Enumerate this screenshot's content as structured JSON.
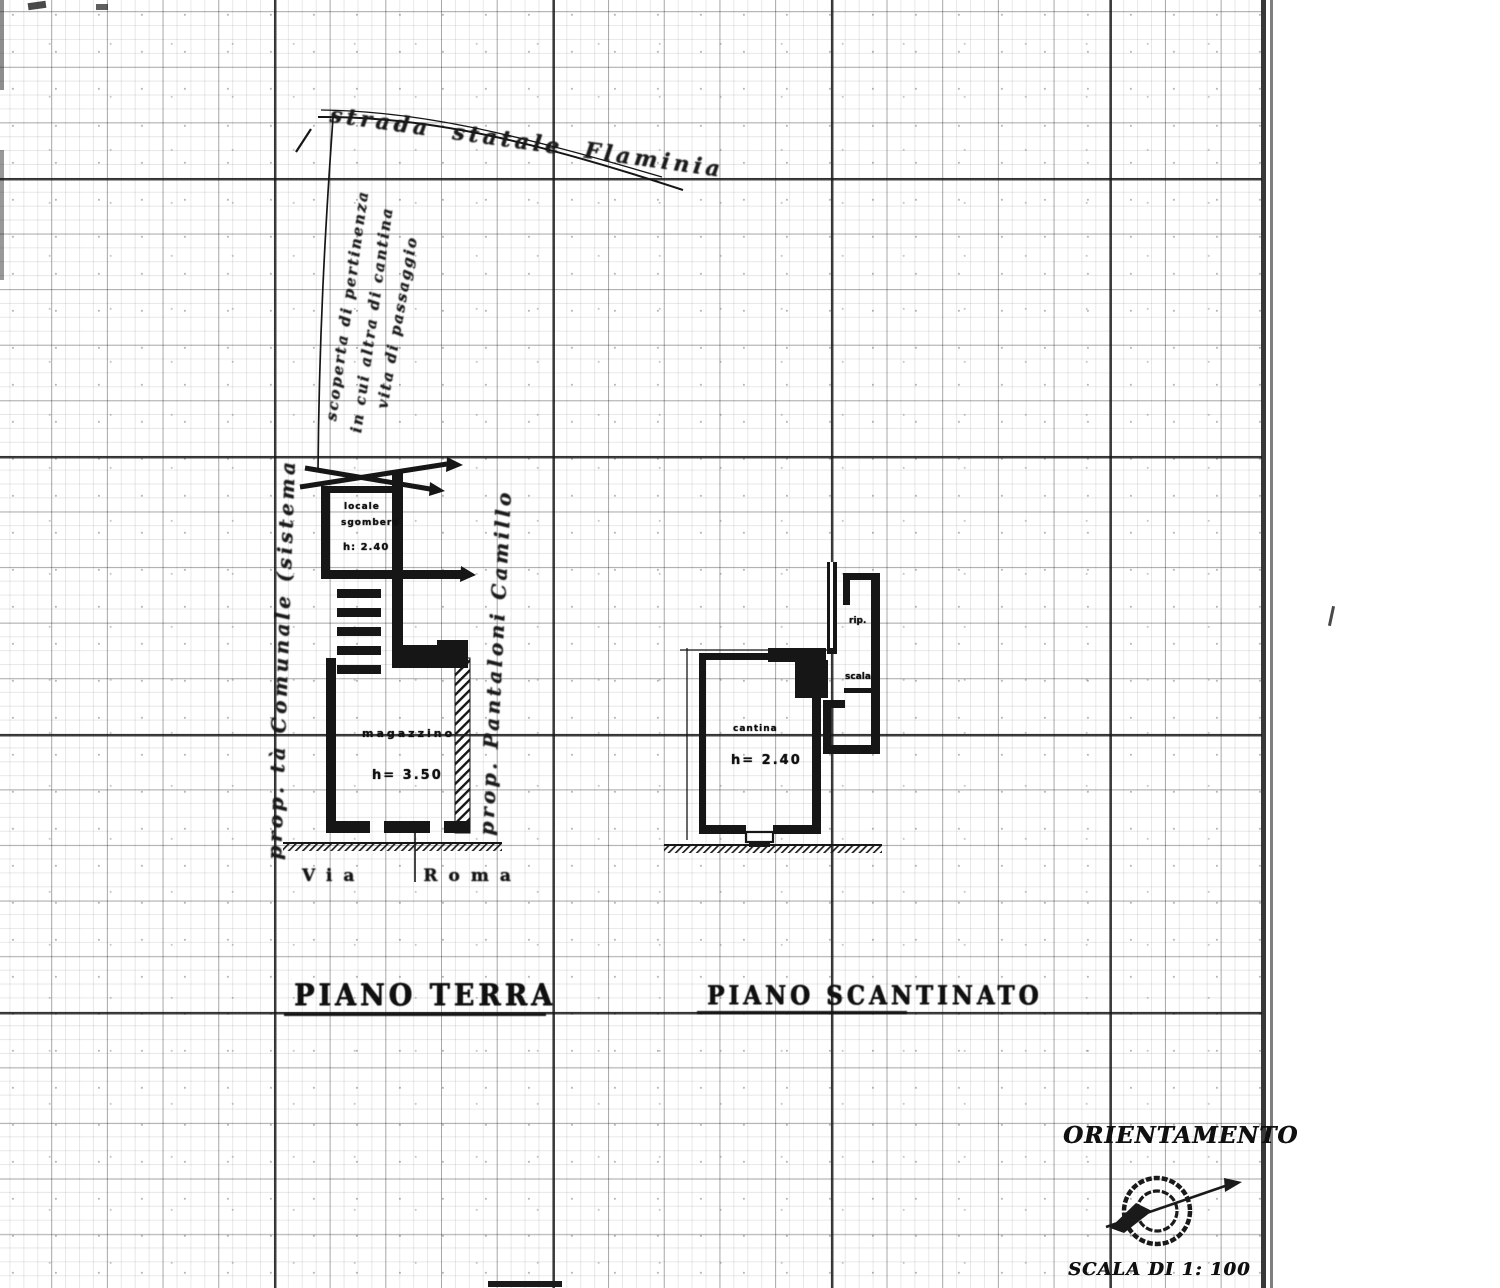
{
  "annotations": {
    "street_label": "strada statale  Flaminia",
    "parcel_notes": [
      "scoperta di pertinenza",
      "in cui altra di cantina",
      "vita di passaggio"
    ],
    "property_left": "prop. tà Comunale (sistema",
    "property_right": "prop. Pantaloni Camillo"
  },
  "street": {
    "word1": "Via",
    "word2": "Roma"
  },
  "ground_floor": {
    "title": "PIANO TERRA",
    "upper_room": [
      "locale",
      "sgombero",
      "h: 2.40"
    ],
    "main_room": {
      "name": "magazzino",
      "height": "h= 3.50"
    }
  },
  "basement": {
    "title": "PIANO SCANTINATO",
    "main_room": {
      "name": "cantina",
      "height": "h= 2.40"
    },
    "annex": [
      "rip.",
      "scala"
    ]
  },
  "orientation": {
    "label": "ORIENTAMENTO"
  },
  "scale": {
    "label": "SCALA DI 1: 100"
  },
  "colors": {
    "ink": "#161616",
    "paper": "#ffffff"
  }
}
